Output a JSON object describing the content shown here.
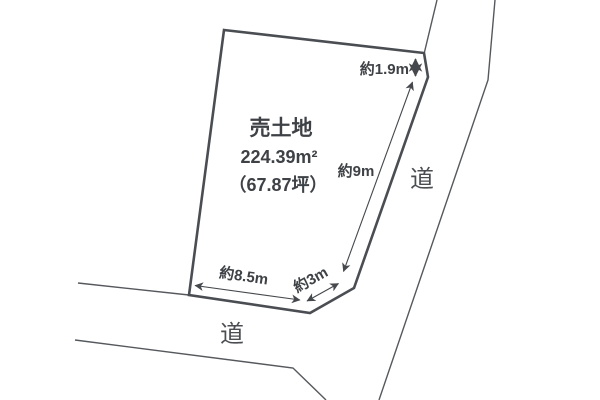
{
  "parcel": {
    "title": "売土地",
    "area_sqm": "224.39m²",
    "area_tsubo": "（67.87坪）"
  },
  "dimensions": {
    "north_east_depth": "約1.9m",
    "east_side": "約9m",
    "south_side": "約8.5m",
    "south_east_corner": "約3m"
  },
  "roads": {
    "east_label": "道",
    "south_label": "道"
  },
  "colors": {
    "line": "#4a4d52",
    "text": "#3e4145",
    "background": "#ffffff"
  }
}
